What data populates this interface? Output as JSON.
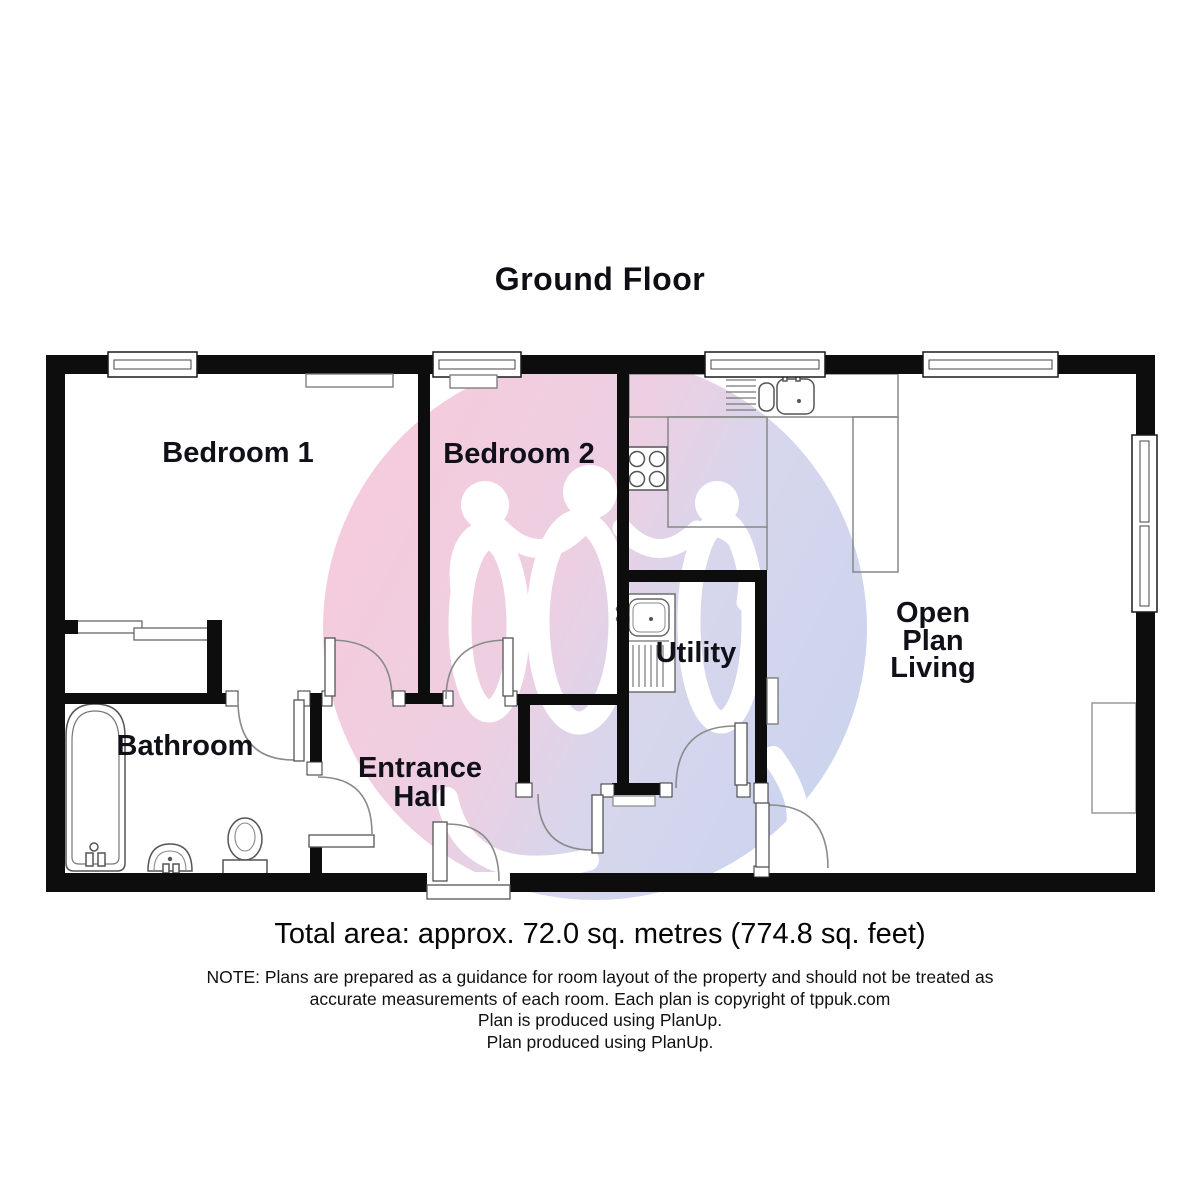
{
  "page": {
    "title": "Ground Floor"
  },
  "rooms": {
    "bedroom1": {
      "label": "Bedroom 1"
    },
    "bedroom2": {
      "label": "Bedroom 2"
    },
    "bathroom": {
      "label": "Bathroom"
    },
    "entrance_hall": {
      "line1": "Entrance",
      "line2": "Hall"
    },
    "utility": {
      "label": "Utility"
    },
    "open_plan_living": {
      "line1": "Open",
      "line2": "Plan",
      "line3": "Living"
    }
  },
  "footer": {
    "total_area": "Total area: approx. 72.0 sq. metres (774.8 sq. feet)",
    "note_line1": "NOTE: Plans are prepared as a guidance for room layout of the property and should not be treated as",
    "note_line2": "accurate measurements of each room. Each plan is copyright of tppuk.com",
    "note_line3": "Plan is produced using PlanUp.",
    "note_line4": "Plan produced using PlanUp."
  },
  "watermark": {
    "pink": "#f6cbdc",
    "blue": "#cbd4ef",
    "figure": "#ffffff"
  },
  "colors": {
    "wall": "#0d0d0d",
    "fixture_outline": "#555555",
    "door_arc": "#8a8a8a",
    "counter_outline": "#888888"
  }
}
